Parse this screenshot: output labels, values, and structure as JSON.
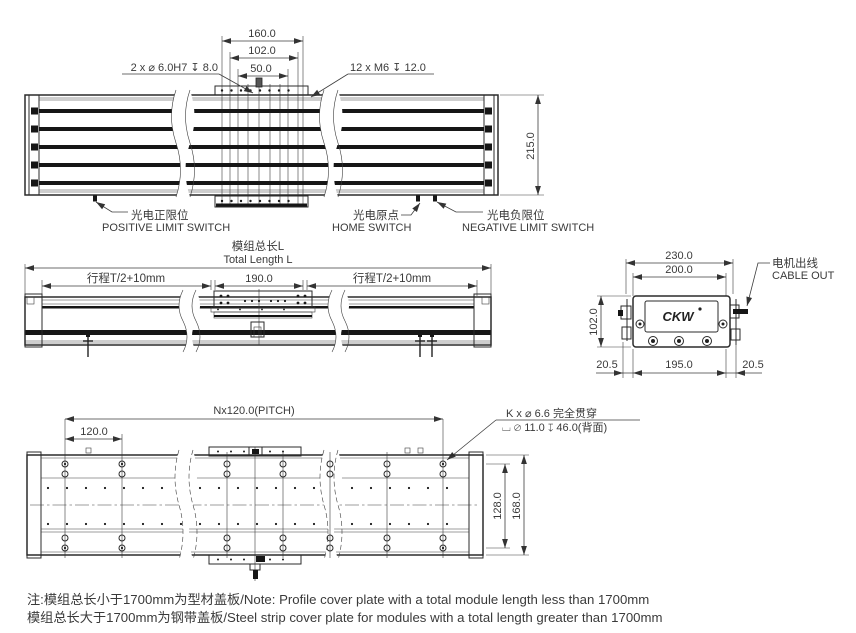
{
  "colors": {
    "line": "#2b2b2b",
    "text": "#3a3a3a",
    "note_red": "#e8434b"
  },
  "top_view": {
    "d160": "160.0",
    "d102": "102.0",
    "d50": "50.0",
    "d215": "215.0",
    "ann_dowel": "2 x  ⌀ 6.0H7 ↧ 8.0",
    "ann_tap": "12 x M6  ↧ 12.0",
    "pos_zh": "光电正限位",
    "pos_en": "POSITIVE LIMIT SWITCH",
    "home_zh": "光电原点",
    "home_en": "HOME  SWITCH",
    "neg_zh": "光电负限位",
    "neg_en": "NEGATIVE  LIMIT  SWITCH"
  },
  "side_view": {
    "title_zh": "模组总长L",
    "title_en": "Total Length L",
    "stroke_left": "行程T/2+10mm",
    "center_len": "190.0",
    "stroke_right": "行程T/2+10mm"
  },
  "end_view": {
    "d230": "230.0",
    "d200": "200.0",
    "d102": "102.0",
    "d205_left": "20.5",
    "d195": "195.0",
    "d205_right": "20.5",
    "cable_zh": "电机出线",
    "cable_en": "CABLE OUT",
    "logo": "CKW"
  },
  "bottom_view": {
    "pitch": "Nx120.0(PITCH)",
    "d120": "120.0",
    "hole_note1": "K x  ⌀ 6.6 完全贯穿",
    "hole_note2": "⌴ ⌀ 11.0  ↧ 46.0(背面)",
    "d128": "128.0",
    "d168": "168.0"
  },
  "note": {
    "line1": "注:模组总长小于1700mm为型材盖板/Note: Profile cover plate with a total module length less than 1700mm",
    "line2": "模组总长大于1700mm为钢带盖板/Steel strip cover plate for modules with a total length greater than 1700mm"
  }
}
